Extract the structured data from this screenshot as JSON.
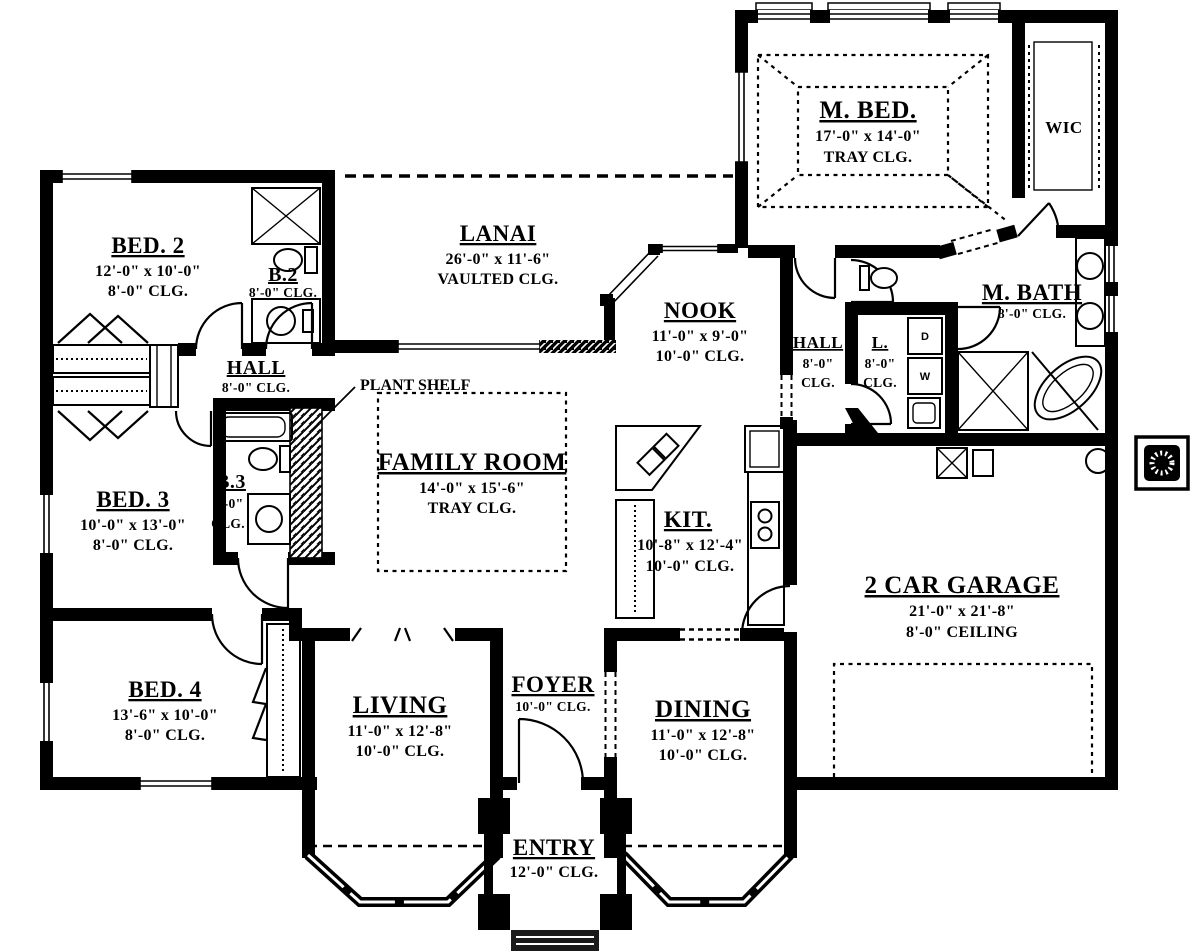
{
  "plan": {
    "rooms": {
      "master_bedroom": {
        "name": "M. BED.",
        "dims": "17'-0\" x 14'-0\"",
        "ceiling": "TRAY CLG."
      },
      "wic": {
        "name": "WIC"
      },
      "bed2": {
        "name": "BED. 2",
        "dims": "12'-0\" x 10'-0\"",
        "ceiling": "8'-0\" CLG."
      },
      "bath2": {
        "name": "B.2",
        "ceiling": "8'-0\" CLG."
      },
      "lanai": {
        "name": "LANAI",
        "dims": "26'-0\" x 11'-6\"",
        "ceiling": "VAULTED CLG."
      },
      "nook": {
        "name": "NOOK",
        "dims": "11'-0\" x 9'-0\"",
        "ceiling": "10'-0\" CLG."
      },
      "hall_west": {
        "name": "HALL",
        "ceiling": "8'-0\" CLG."
      },
      "hall_east": {
        "name": "HALL",
        "ceiling_line1": "8'-0\"",
        "ceiling_line2": "CLG."
      },
      "laundry": {
        "name": "L.",
        "ceiling_line1": "8'-0\"",
        "ceiling_line2": "CLG."
      },
      "master_bath": {
        "name": "M. BATH",
        "ceiling": "8'-0\" CLG."
      },
      "family_room": {
        "name": "FAMILY ROOM",
        "dims": "14'-0\" x 15'-6\"",
        "ceiling": "TRAY CLG."
      },
      "bed3": {
        "name": "BED. 3",
        "dims": "10'-0\" x 13'-0\"",
        "ceiling": "8'-0\" CLG."
      },
      "bath3": {
        "name": "B.3",
        "ceiling_line1": "8'-0\"",
        "ceiling_line2": "CLG."
      },
      "kitchen": {
        "name": "KIT.",
        "dims": "10'-8\" x 12'-4\"",
        "ceiling": "10'-0\" CLG."
      },
      "garage": {
        "name": "2 CAR GARAGE",
        "dims": "21'-0\" x 21'-8\"",
        "ceiling": "8'-0\" CEILING"
      },
      "bed4": {
        "name": "BED. 4",
        "dims": "13'-6\" x 10'-0\"",
        "ceiling": "8'-0\" CLG."
      },
      "living": {
        "name": "LIVING",
        "dims": "11'-0\" x 12'-8\"",
        "ceiling": "10'-0\" CLG."
      },
      "foyer": {
        "name": "FOYER",
        "ceiling": "10'-0\" CLG."
      },
      "dining": {
        "name": "DINING",
        "dims": "11'-0\" x 12'-8\"",
        "ceiling": "10'-0\" CLG."
      },
      "entry": {
        "name": "ENTRY",
        "ceiling": "12'-0\" CLG."
      }
    },
    "annotations": {
      "plant_shelf": "PLANT SHELF"
    },
    "appliances": {
      "dryer_label": "D",
      "washer_label": "W"
    },
    "colors": {
      "wall": "#000000",
      "paper": "#ffffff"
    }
  }
}
